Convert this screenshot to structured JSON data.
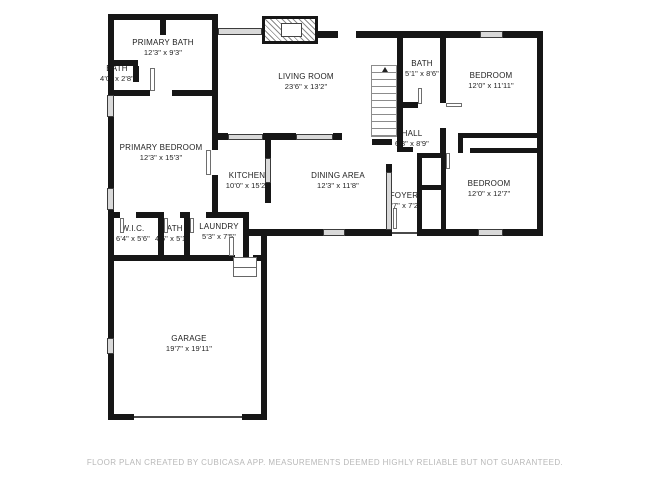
{
  "plan": {
    "rooms": [
      {
        "name": "PRIMARY BATH",
        "dims": "12'3\" x 9'3\""
      },
      {
        "name": "BATH",
        "dims": "4'0\" x 2'8\""
      },
      {
        "name": "PRIMARY BEDROOM",
        "dims": "12'3\" x 15'3\""
      },
      {
        "name": "LIVING ROOM",
        "dims": "23'6\" x 13'2\""
      },
      {
        "name": "BATH",
        "dims": "5'1\" x 8'6\""
      },
      {
        "name": "BEDROOM",
        "dims": "12'0\" x 11'11\""
      },
      {
        "name": "HALL",
        "dims": "6'8\" x 8'9\""
      },
      {
        "name": "KITCHEN",
        "dims": "10'0\" x 15'2\""
      },
      {
        "name": "DINING AREA",
        "dims": "12'3\" x 11'8\""
      },
      {
        "name": "FOYER",
        "dims": "3'7\" x 7'2\""
      },
      {
        "name": "BEDROOM",
        "dims": "12'0\" x 12'7\""
      },
      {
        "name": "W.I.C.",
        "dims": "6'4\" x 5'6\""
      },
      {
        "name": "BATH",
        "dims": "4'6\" x 5'1\""
      },
      {
        "name": "LAUNDRY",
        "dims": "5'3\" x 7'5\""
      },
      {
        "name": "GARAGE",
        "dims": "19'7\" x 19'11\""
      }
    ],
    "footer": "FLOOR PLAN CREATED BY CUBICASA APP. MEASUREMENTS DEEMED HIGHLY RELIABLE BUT NOT GUARANTEED.",
    "colors": {
      "wall": "#161616",
      "window": "#d9d9d9",
      "footer_text": "#b8b8b8",
      "background": "#ffffff"
    }
  }
}
